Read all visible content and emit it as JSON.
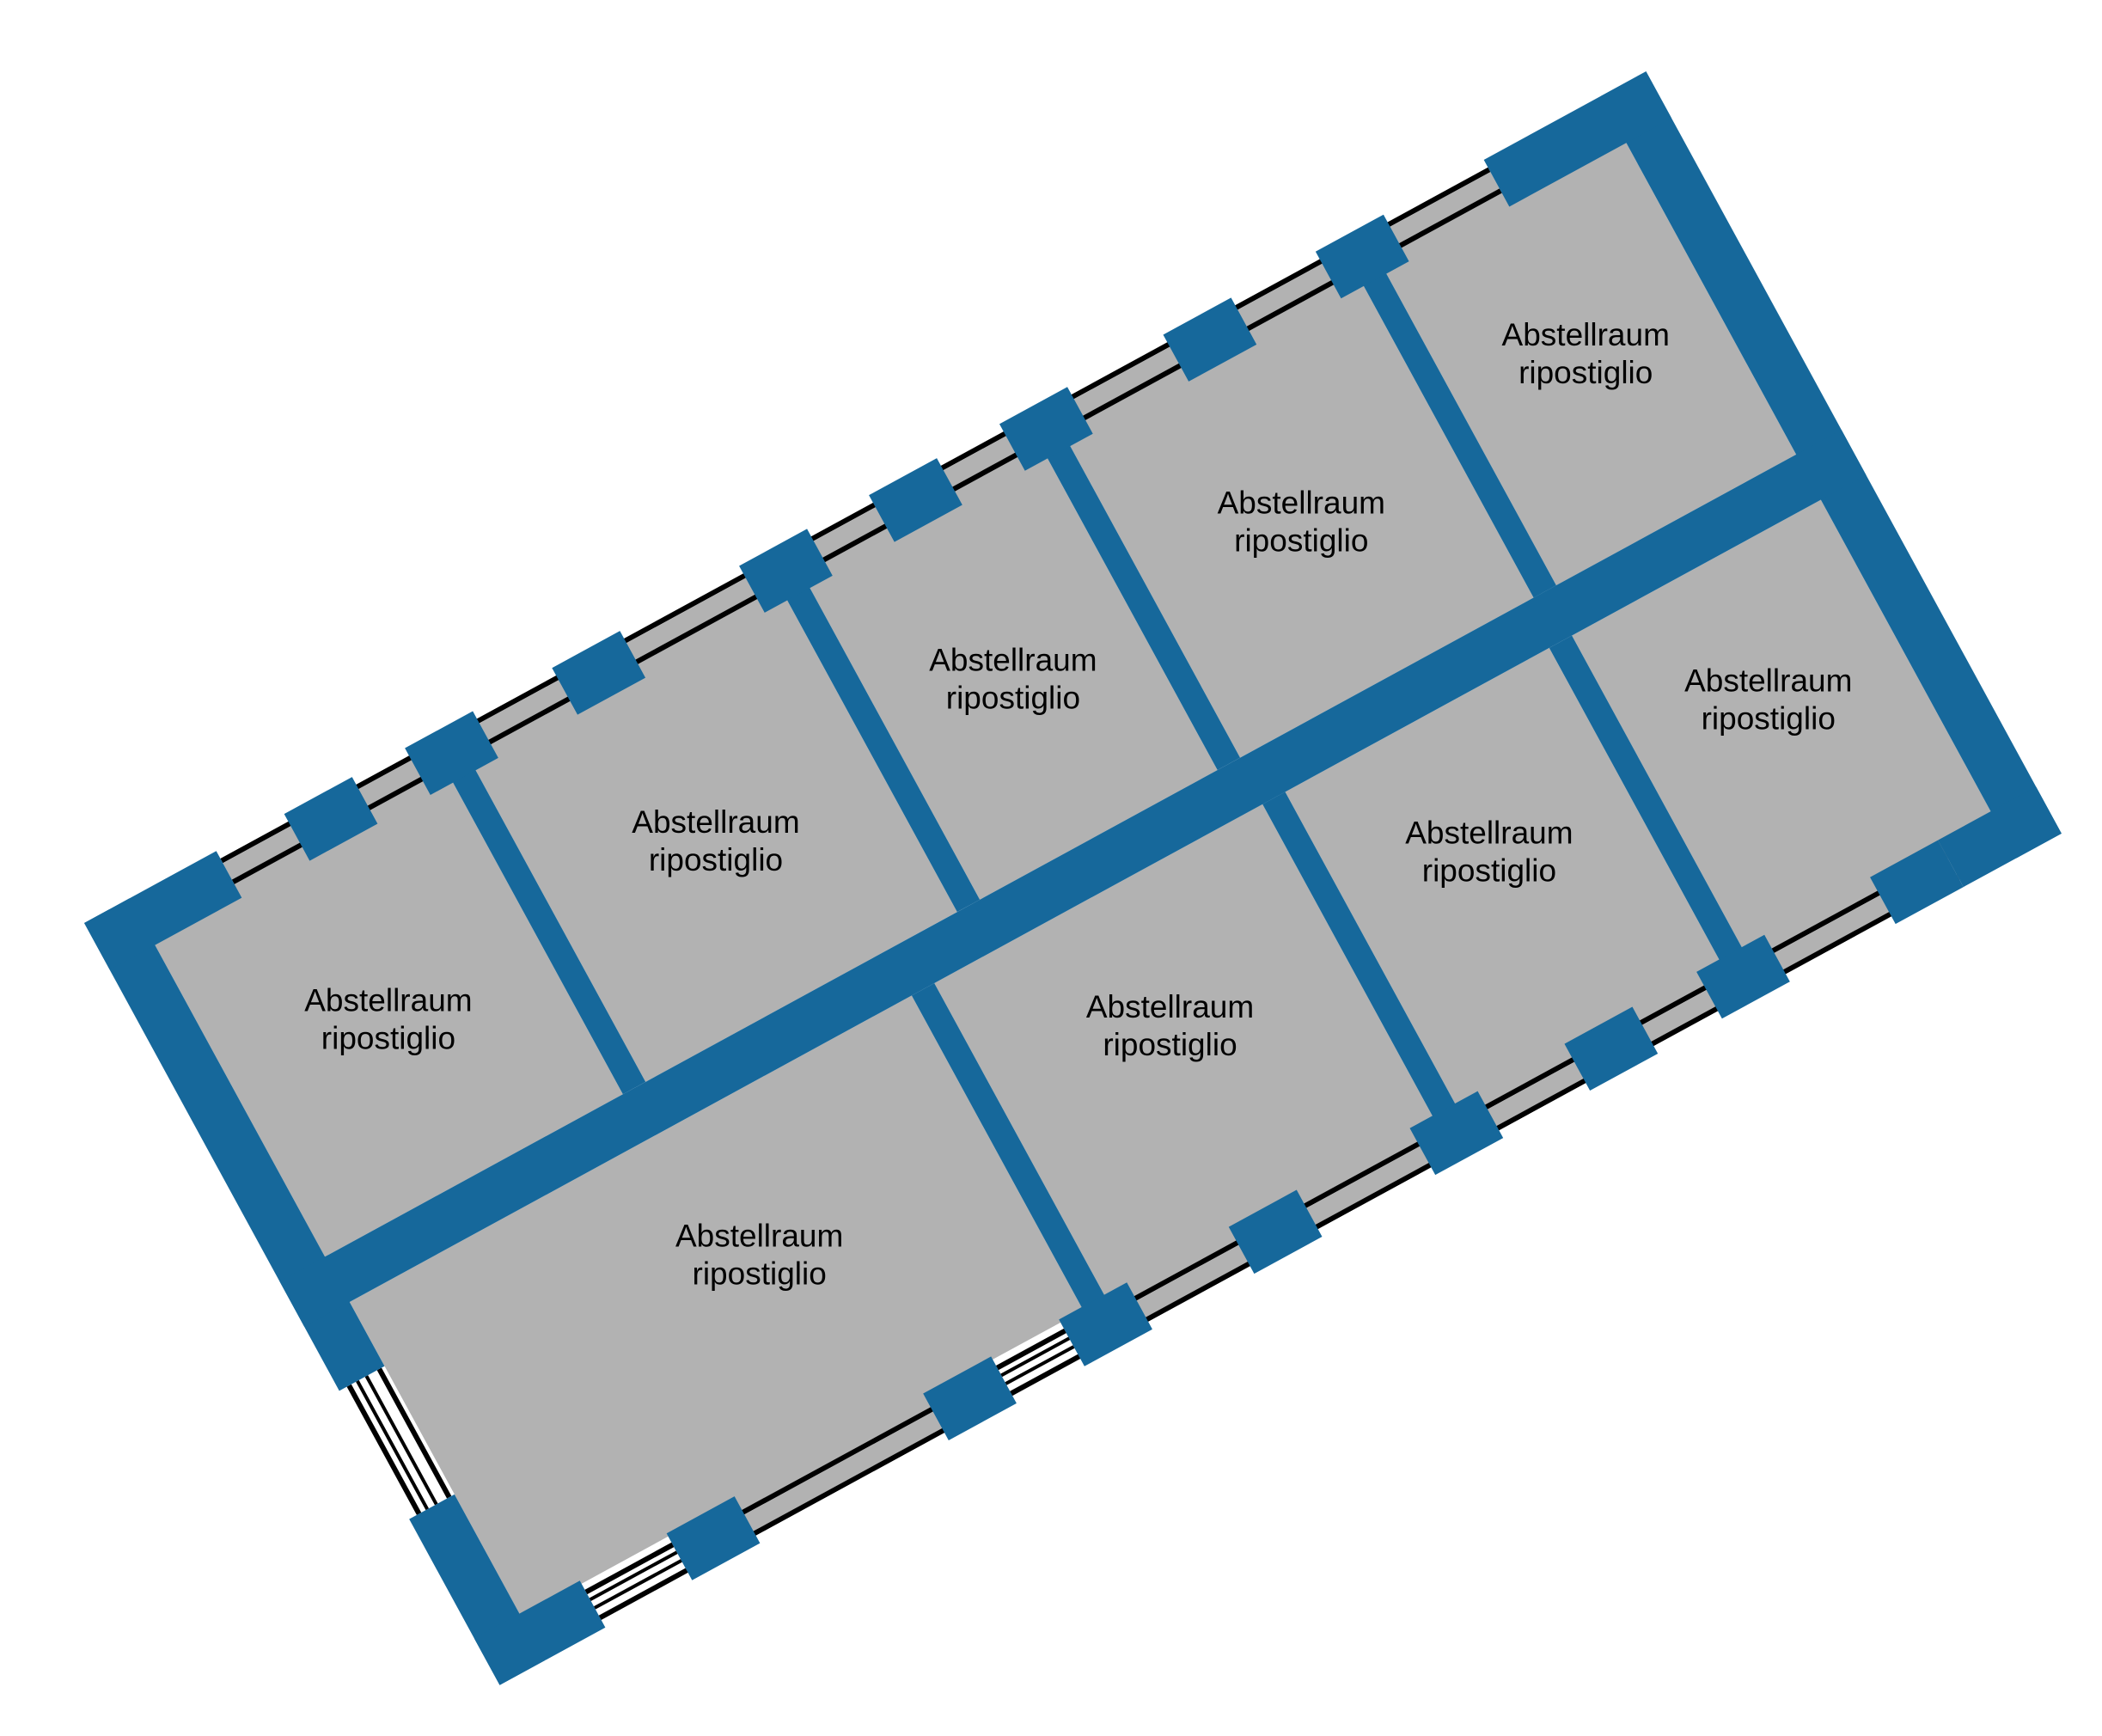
{
  "plan": {
    "type": "floor-plan",
    "rooms": [
      {
        "line1": "Abstellraum",
        "line2": "ripostiglio",
        "row": "top",
        "position": 1
      },
      {
        "line1": "Abstellraum",
        "line2": "ripostiglio",
        "row": "top",
        "position": 2
      },
      {
        "line1": "Abstellraum",
        "line2": "ripostiglio",
        "row": "top",
        "position": 3
      },
      {
        "line1": "Abstellraum",
        "line2": "ripostiglio",
        "row": "top",
        "position": 4
      },
      {
        "line1": "Abstellraum",
        "line2": "ripostiglio",
        "row": "top",
        "position": 5
      },
      {
        "line1": "Abstellraum",
        "line2": "ripostiglio",
        "row": "bottom",
        "position": 1
      },
      {
        "line1": "Abstellraum",
        "line2": "ripostiglio",
        "row": "bottom",
        "position": 2
      },
      {
        "line1": "Abstellraum",
        "line2": "ripostiglio",
        "row": "bottom",
        "position": 3
      },
      {
        "line1": "Abstellraum",
        "line2": "ripostiglio",
        "row": "bottom",
        "position": 4
      }
    ],
    "colors": {
      "wall": "#16689b",
      "room": "#b2b2b2",
      "line": "#000000",
      "background": "#ffffff"
    }
  }
}
